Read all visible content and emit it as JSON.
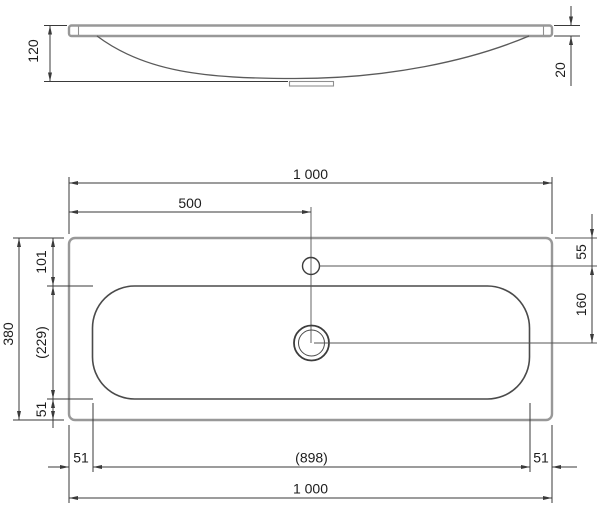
{
  "side_view": {
    "dim_basin_depth": "120",
    "dim_rim_thickness": "20"
  },
  "plan_view": {
    "dim_overall_width_top": "1 000",
    "dim_tap_center_from_left": "500",
    "dim_overall_depth": "380",
    "dim_back_edge_to_bowl": "101",
    "dim_bowl_depth_ref": "(229)",
    "dim_bowl_to_front_edge": "51",
    "dim_back_edge_to_tap_hole": "55",
    "dim_tap_hole_to_drain": "160",
    "dim_left_edge_to_bowl": "51",
    "dim_bowl_width_ref": "(898)",
    "dim_bowl_to_right_edge": "51",
    "dim_overall_width_bottom": "1 000"
  },
  "colors": {
    "product_outline": "#989898",
    "basin_outline": "#4a4a4a",
    "dimension_lines": "#3a3a3a",
    "text": "#1c1c1c",
    "background": "#ffffff"
  }
}
